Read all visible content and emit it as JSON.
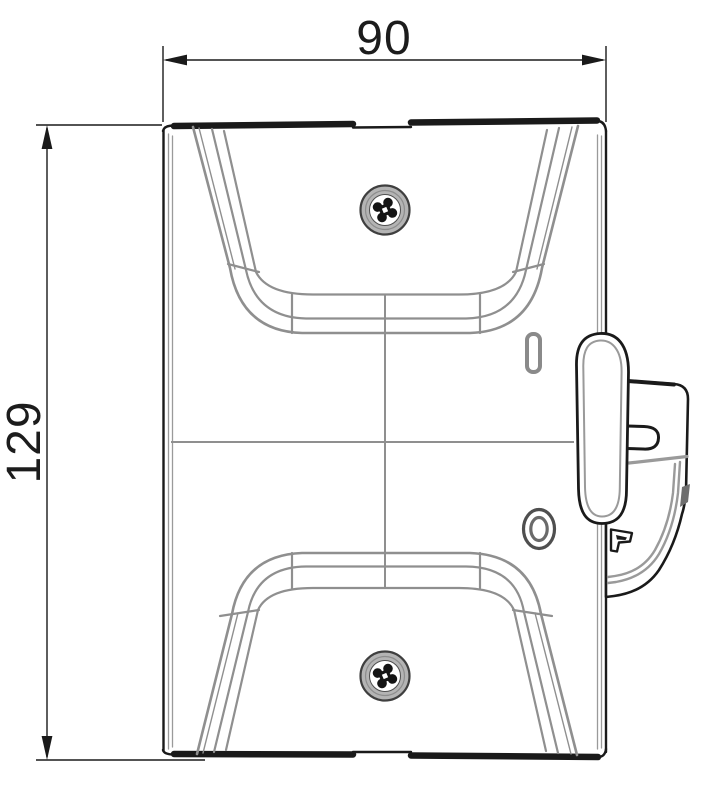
{
  "drawing": {
    "view_type": "orthographic front view of wall-mount bracket",
    "dimensions": {
      "width": {
        "label": "90",
        "axis": "horizontal",
        "position": "top"
      },
      "height": {
        "label": "129",
        "axis": "vertical",
        "position": "left"
      }
    },
    "parts": {
      "top_screw": "phillips-screw",
      "bottom_screw": "phillips-screw",
      "upper_pocket": "upper-recess",
      "lower_pocket": "lower-recess",
      "slot": "indicator-slot",
      "oval_hole": "oval-aperture",
      "latch_lever": "side-latch-lever",
      "latch_bracket": "side-mount-bracket"
    },
    "colors": {
      "outline": "#1a1a1a",
      "detail_line": "#8f8f8f",
      "screw_ring": "#b4b4b4",
      "dimension_text": "#1c1c1c",
      "background": "#ffffff"
    }
  }
}
